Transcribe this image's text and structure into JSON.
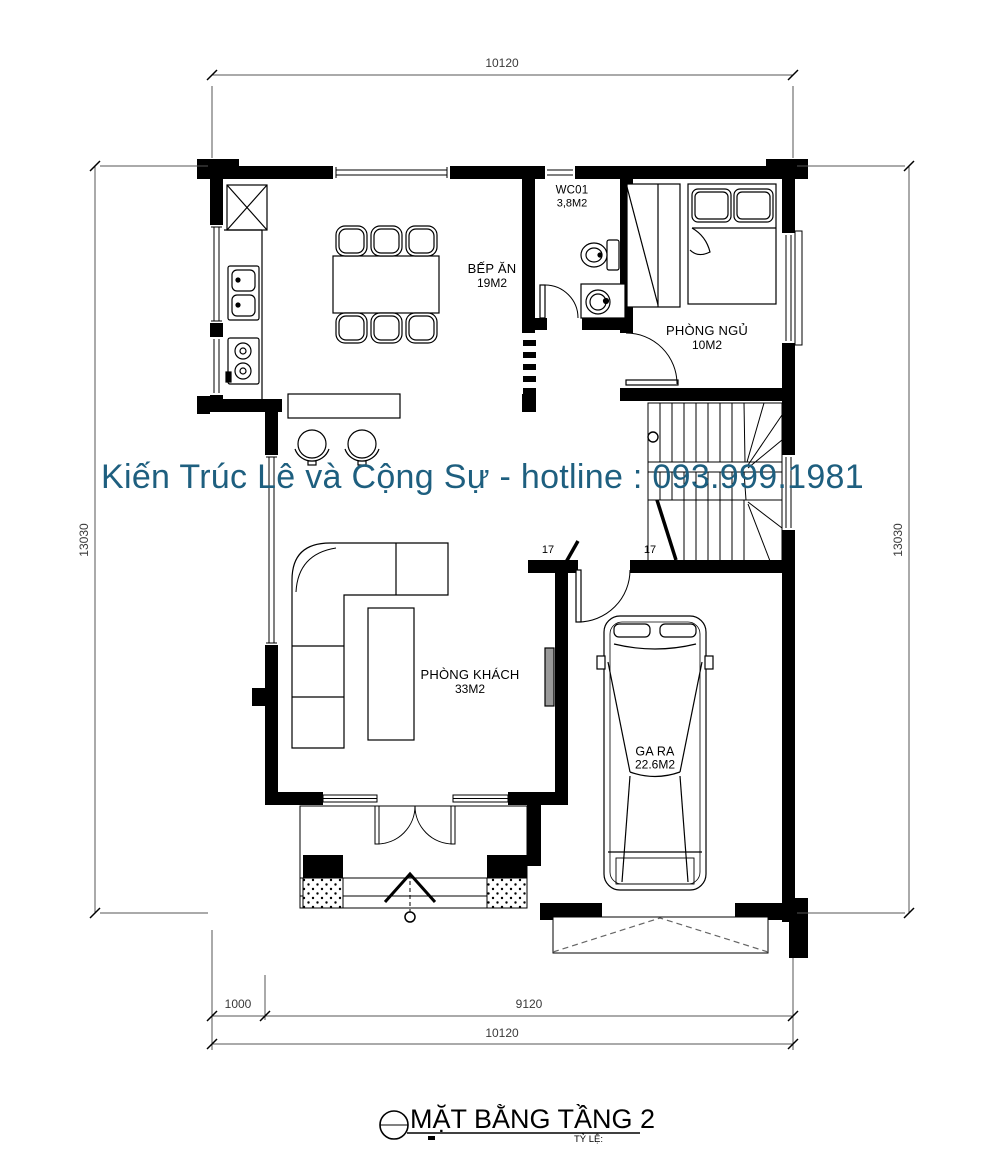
{
  "watermark": {
    "text": "Kiến Trúc Lê và Cộng Sự - hotline : 093.999.1981",
    "color": "#1e5f7f"
  },
  "title": {
    "text": "MẶT BẰNG TẦNG 2",
    "scale_label": "TỶ LỆ:"
  },
  "rooms": {
    "kitchen": {
      "name": "BẾP ĂN",
      "area": "19M2"
    },
    "wc": {
      "name": "WC01",
      "area": "3,8M2"
    },
    "bedroom": {
      "name": "PHÒNG NGỦ",
      "area": "10M2"
    },
    "living_room": {
      "name": "PHÒNG KHÁCH",
      "area": "33M2"
    },
    "garage": {
      "name": "GA RA",
      "area": "22.6M2"
    }
  },
  "stairs": {
    "riser_count": "17"
  },
  "dimensions": {
    "top_width": "10120",
    "left_height": "13030",
    "right_height": "13030",
    "bottom_offset": "1000",
    "bottom_main": "9120",
    "bottom_total": "10120"
  },
  "colors": {
    "walls": "#000000",
    "watermark": "#1e5f7f",
    "dimension_lines": "#555555"
  }
}
